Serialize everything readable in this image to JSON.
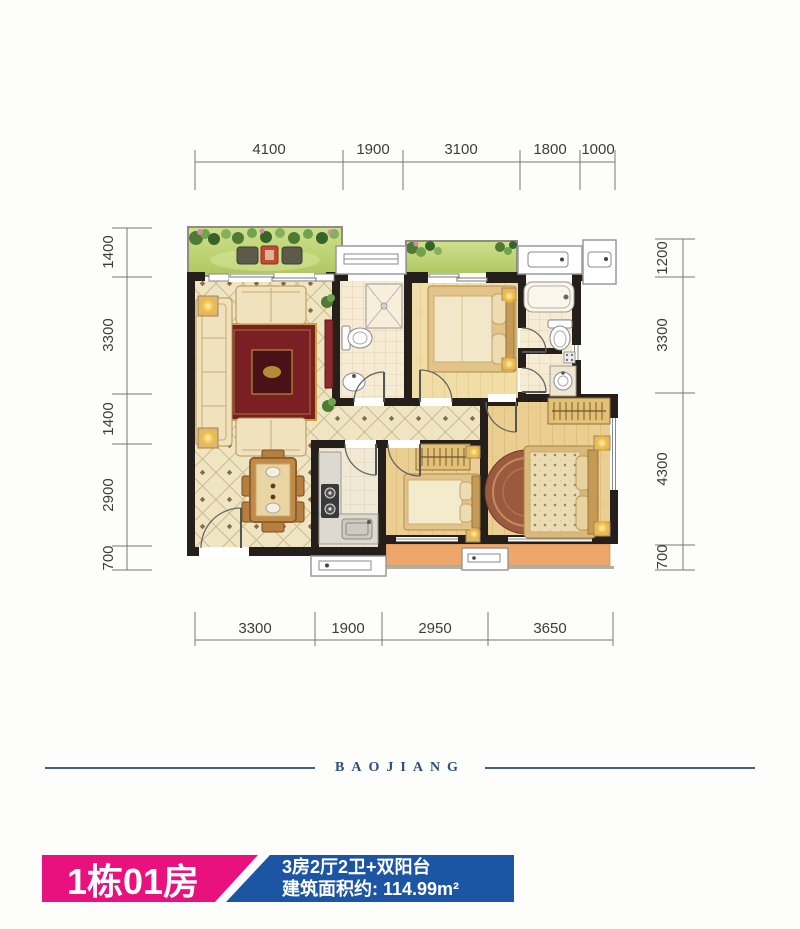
{
  "floor_plan": {
    "dims_top": [
      "4100",
      "1900",
      "3100",
      "1800",
      "1000"
    ],
    "dims_bottom": [
      "3300",
      "1900",
      "2950",
      "3650"
    ],
    "dims_left": [
      "1400",
      "3300",
      "1400",
      "2900",
      "700"
    ],
    "dims_right": [
      "1200",
      "3300",
      "4300",
      "700"
    ]
  },
  "brand": {
    "name": "BAOJIANG"
  },
  "footer": {
    "unit_label": "1栋01房",
    "layout_label": "3房2厅2卫+双阳台",
    "area_label": "建筑面积约: 114.99m²"
  },
  "colors": {
    "pink": "#e8117d",
    "blue": "#1d55a5",
    "navy": "#2c4e7e"
  }
}
